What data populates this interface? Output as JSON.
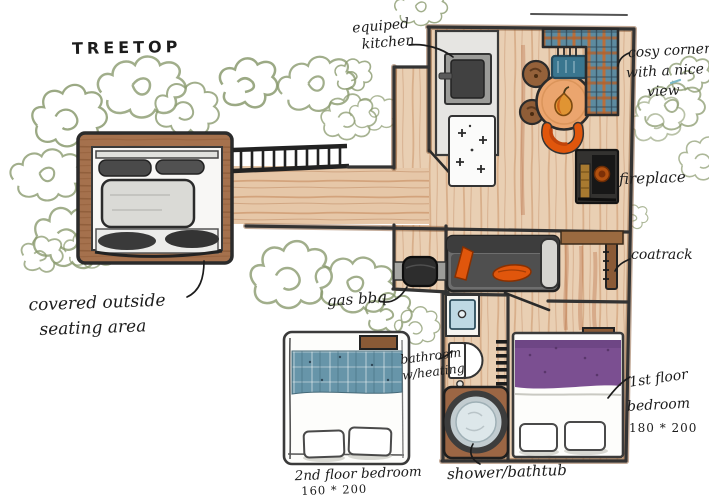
{
  "title": "TREETOP",
  "labels": {
    "kitchen": {
      "line1": "equiped",
      "line2": "kitchen"
    },
    "cosy_corner": {
      "line1": "cosy corner",
      "line2": "with a nice",
      "line3": "view"
    },
    "fireplace": {
      "text": "fireplace"
    },
    "coatrack": {
      "text": "coatrack"
    },
    "outside_seating": {
      "line1": "covered outside",
      "line2": "seating area"
    },
    "gas_bbq": {
      "text": "gas bbq"
    },
    "bathroom": {
      "line1": "bathroom",
      "line2": "w/heating"
    },
    "shower": {
      "text": "shower/bathtub"
    },
    "bedroom_first": {
      "line1": "1st floor",
      "line2": "bedroom",
      "line3": "180 * 200"
    },
    "bedroom_second": {
      "line1": "2nd floor bedroom",
      "line2": "160 * 200"
    }
  },
  "palette": {
    "paper": "#ffffff",
    "ink": "#1c1c1c",
    "wall": "#3a3a3a",
    "floor_wood": "#e9cfb3",
    "wood_streak": "#c4875a",
    "deck_brown": "#a5714d",
    "foliage_green": "#8a9a6e",
    "sofa_gray": "#6e6e6e",
    "cushion_dark": "#3d3d3d",
    "accent_orange": "#e0560c",
    "table_orange": "#eba56e",
    "plaid_teal": "#5d8ba0",
    "plaid_orange": "#c96a2a",
    "bed_teal": "#6795a9",
    "bed_purple": "#7b4f91",
    "basin_blue": "#bed9e4",
    "wood_brown": "#8a5a36",
    "ember_orange": "#b2500f"
  }
}
